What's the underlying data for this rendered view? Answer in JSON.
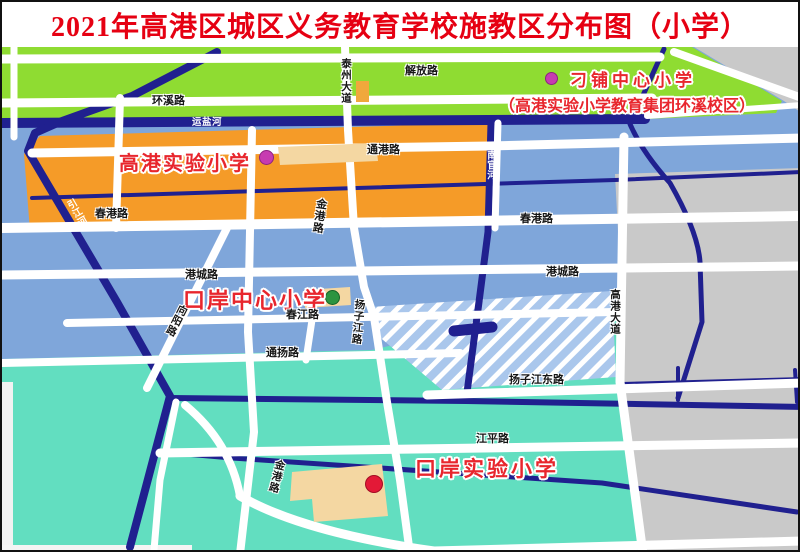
{
  "title": "2021年高港区城区义务教育学校施教区分布图（小学）",
  "schools": [
    {
      "name": "刁铺中心小学",
      "subtitle": "（高港实验小学教育集团环溪校区）",
      "marker": "magenta-dot"
    },
    {
      "name": "高港实验小学",
      "marker": "magenta-dot"
    },
    {
      "name": "口岸中心小学",
      "marker": "green-dot"
    },
    {
      "name": "口岸实验小学",
      "marker": "red-dot"
    }
  ],
  "road_labels": [
    "环溪路",
    "泰州大道",
    "解放路",
    "通港路",
    "春港路",
    "春港路",
    "金港路",
    "港城路",
    "港城路",
    "春江路",
    "扬子江路",
    "向阳路",
    "通扬路",
    "高港大道",
    "扬子江东路",
    "江平路",
    "金港路"
  ],
  "river_labels": [
    "运盐河",
    "引江河",
    "南官河"
  ],
  "colors": {
    "title_red": "#e60012",
    "school_label_red": "#e8262d",
    "district_green": "#8fdc32",
    "district_orange": "#f59b28",
    "district_blue": "#7fa6da",
    "district_teal": "#62dec0",
    "district_gray": "#c9c9c9",
    "hatched_blue": "#aac7ec",
    "river_navy": "#20208f",
    "road_white": "#ffffff",
    "building_tan": "#f4d7a2",
    "marker_magenta": "#c73bb1",
    "marker_green": "#2b9440",
    "marker_red": "#e31937"
  }
}
